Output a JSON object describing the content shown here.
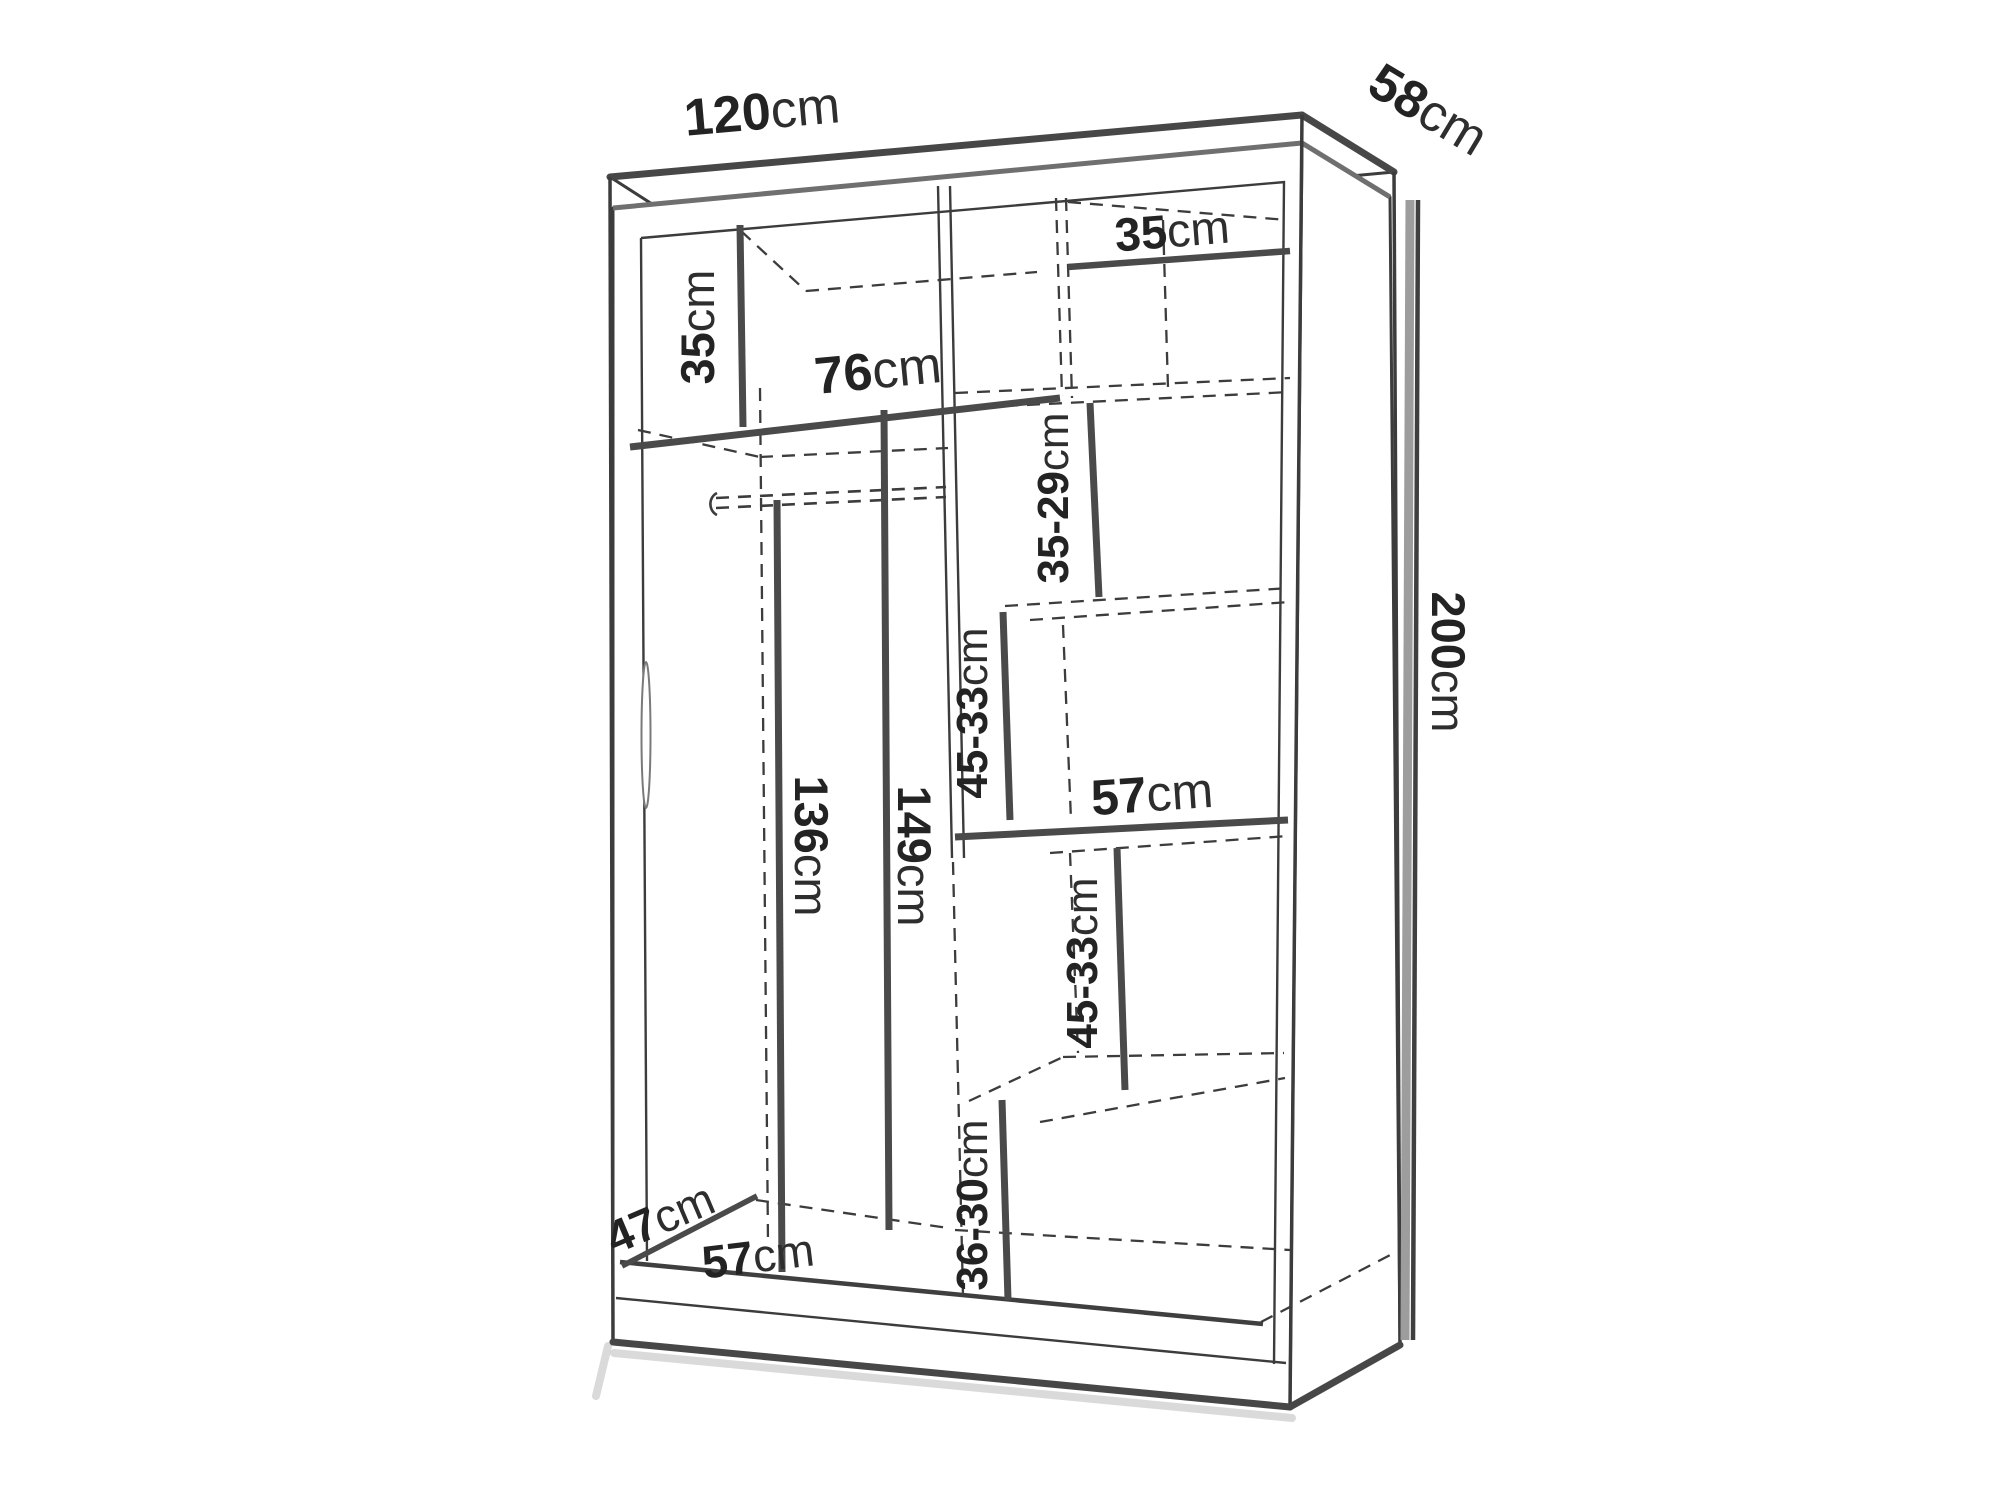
{
  "diagram": {
    "name": "wardrobe-dimensions-diagram",
    "unit_suffix": "cm",
    "labels": {
      "overall_width": {
        "value": "120",
        "unit": "cm"
      },
      "overall_depth": {
        "value": "58",
        "unit": "cm"
      },
      "overall_height": {
        "value": "200",
        "unit": "cm"
      },
      "top_left_shelf_height": {
        "value": "35",
        "unit": "cm"
      },
      "top_center_opening_width": {
        "value": "76",
        "unit": "cm"
      },
      "top_right_shelf_width": {
        "value": "35",
        "unit": "cm"
      },
      "right_zone1_height": {
        "value": "35-29",
        "unit": "cm"
      },
      "right_zone2_height": {
        "value": "45-33",
        "unit": "cm"
      },
      "right_middle_shelf_width": {
        "value": "57",
        "unit": "cm"
      },
      "right_zone3_height": {
        "value": "45-33",
        "unit": "cm"
      },
      "right_zone4_height": {
        "value": "36-30",
        "unit": "cm"
      },
      "hanging_front_height": {
        "value": "136",
        "unit": "cm"
      },
      "hanging_back_height": {
        "value": "149",
        "unit": "cm"
      },
      "interior_depth": {
        "value": "47",
        "unit": "cm"
      },
      "interior_bottom_width": {
        "value": "57",
        "unit": "cm"
      }
    },
    "colors": {
      "background": "#ffffff",
      "line": "#3c3c3c",
      "measure_line": "#4a4a4a",
      "crown_gray": "#6f6f6f",
      "measure_band_gray": "#9d9d9d",
      "text": "#232323",
      "shadow": "#c2c2c2"
    }
  }
}
